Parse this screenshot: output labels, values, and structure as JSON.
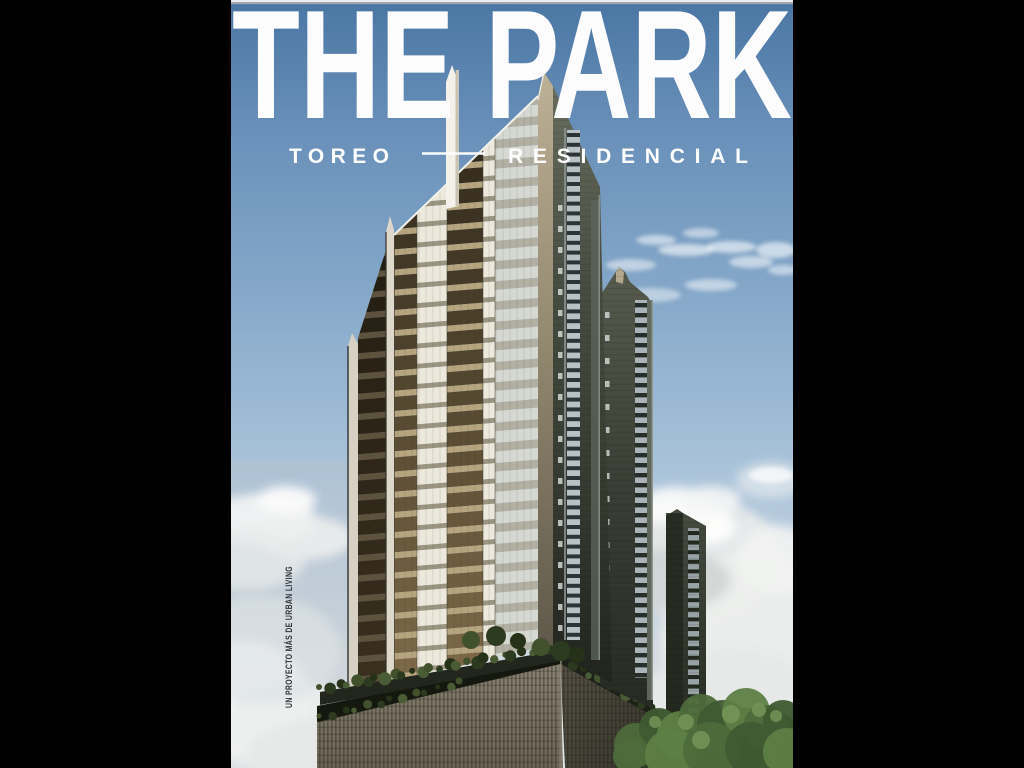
{
  "poster": {
    "title": "THE PARK",
    "subtitle": {
      "left": "TOREO",
      "right": "RESIDENCIAL"
    },
    "vertical_credit": "UN PROYECTO MÁS DE URBAN LIVING",
    "colors": {
      "letterbox": "#000000",
      "sky_top": "#4a76a4",
      "sky_mid": "#85a8c9",
      "sky_low": "#c8d4de",
      "cloud_white": "#f4f5f4",
      "title_text": "#fdfdfd",
      "subtitle_text": "#fdfdfd",
      "credit_text": "#2f3438",
      "facade_cream": "#ece8db",
      "facade_balcony_slab": "#b6a57e",
      "facade_balcony_dark": "#2e2719",
      "tower_dark": "#3f453c",
      "window_strip": "#b8c1c6",
      "corner_fin_beige": "#bcb096",
      "podium_lattice": "#7e7767",
      "cornice_dark": "#23261d",
      "greenery": "#41512c",
      "tree_green": "#4e6c3b"
    }
  }
}
